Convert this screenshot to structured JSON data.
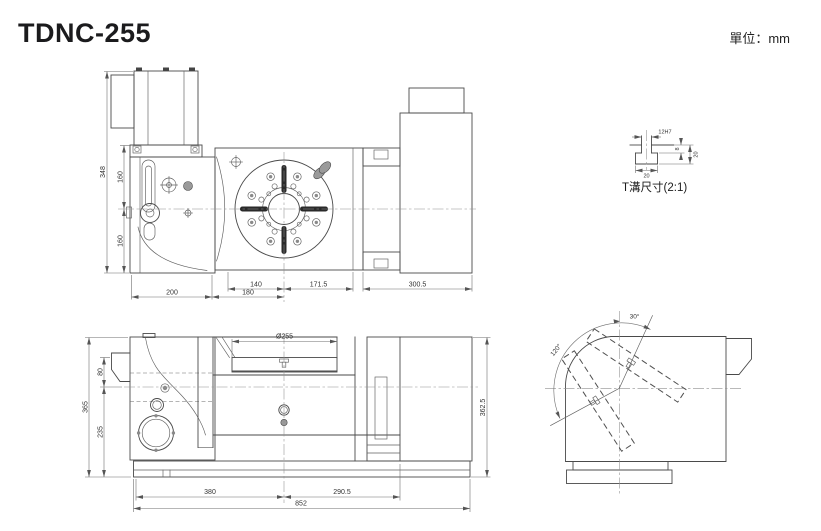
{
  "title": "TDNC-255",
  "units_label": "單位：mm",
  "line_color": "#4a4a4a",
  "views": {
    "top_view": {
      "dims": {
        "total_height": "348",
        "upper_height": "160",
        "lower_height": "160",
        "base_width": "200",
        "left_width": "180",
        "plate_left": "140",
        "plate_right": "171.5",
        "right_width": "300.5"
      }
    },
    "front_view": {
      "dims": {
        "total_height": "365",
        "surface_to_center": "80",
        "center_to_base": "235",
        "table_diameter": "Ø255",
        "right_height": "362.5",
        "left_length": "380",
        "right_length": "290.5",
        "overall_length": "852"
      }
    },
    "side_view": {
      "dims": {
        "tilt_back": "30°",
        "tilt_front": "120°"
      }
    },
    "tslot_detail": {
      "label": "T溝尺寸(2:1)",
      "dims": {
        "slot_width": "12H7",
        "base_width": "20",
        "total_depth": "20",
        "neck_depth": "8"
      }
    }
  }
}
